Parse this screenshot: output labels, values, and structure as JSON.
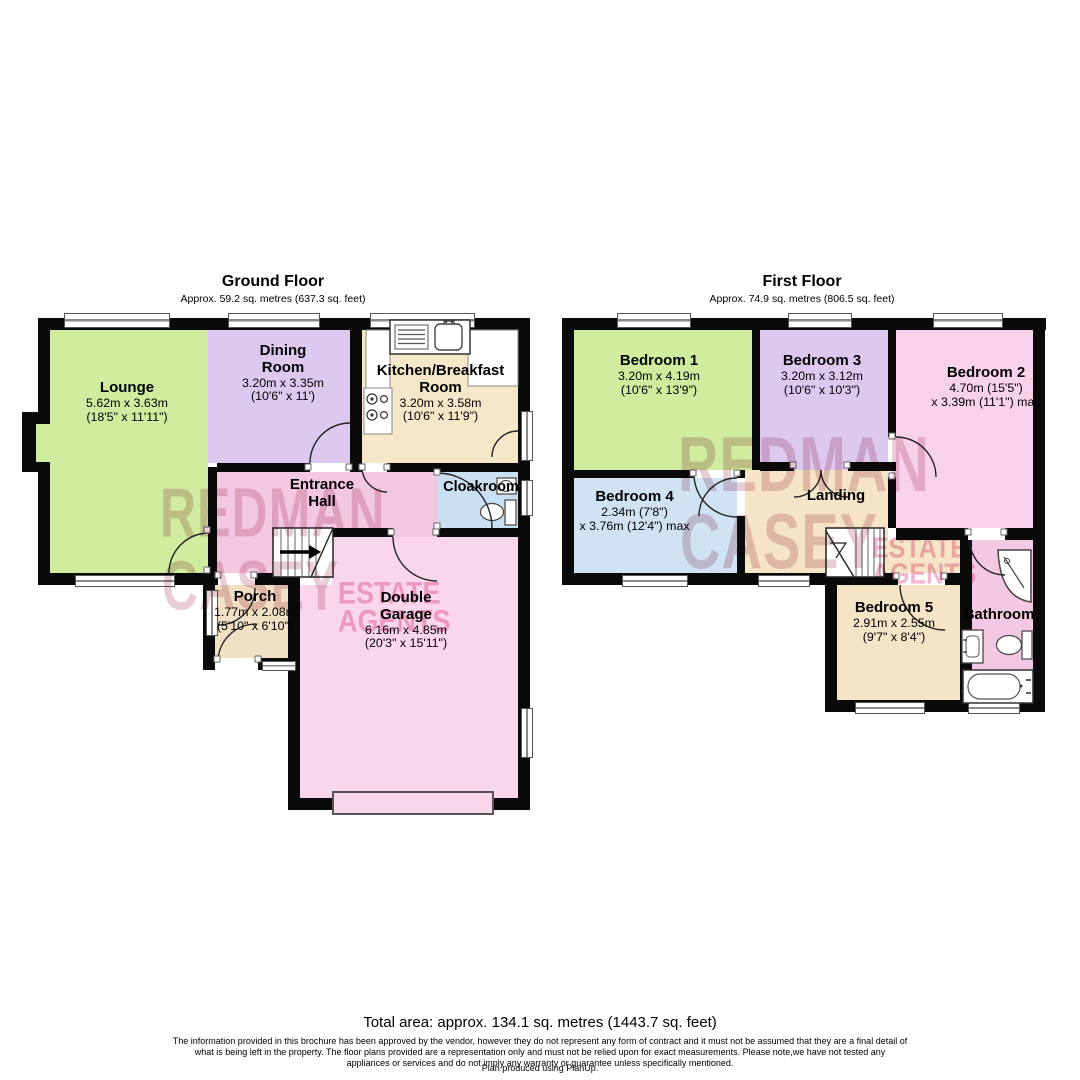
{
  "ground_floor": {
    "title": "Ground Floor",
    "subtitle": "Approx. 59.2 sq. metres (637.3 sq. feet)",
    "rooms": {
      "lounge": {
        "name": "Lounge",
        "dim_metric": "5.62m x 3.63m",
        "dim_imperial": "(18'5\" x 11'11\")"
      },
      "dining_room": {
        "name": "Dining Room",
        "dim_metric": "3.20m x 3.35m",
        "dim_imperial": "(10'6\" x 11')"
      },
      "kitchen": {
        "name": "Kitchen/Breakfast Room",
        "dim_metric": "3.20m x 3.58m",
        "dim_imperial": "(10'6\" x 11'9\")"
      },
      "entrance_hall": {
        "name": "Entrance Hall"
      },
      "cloakroom": {
        "name": "Cloakroom"
      },
      "porch": {
        "name": "Porch",
        "dim_metric": "1.77m x 2.08m",
        "dim_imperial": "(5'10\" x 6'10\")"
      },
      "double_garage": {
        "name": "Double Garage",
        "dim_metric": "6.16m x 4.85m",
        "dim_imperial": "(20'3\" x 15'11\")"
      }
    }
  },
  "first_floor": {
    "title": "First Floor",
    "subtitle": "Approx. 74.9 sq. metres (806.5 sq. feet)",
    "rooms": {
      "bedroom1": {
        "name": "Bedroom 1",
        "dim_metric": "3.20m x 4.19m",
        "dim_imperial": "(10'6\" x 13'9\")"
      },
      "bedroom3": {
        "name": "Bedroom 3",
        "dim_metric": "3.20m x 3.12m",
        "dim_imperial": "(10'6\" x 10'3\")"
      },
      "bedroom2": {
        "name": "Bedroom 2",
        "dim_metric": "4.70m (15'5\")",
        "dim_imperial": "x 3.39m (11'1\") max"
      },
      "bedroom4": {
        "name": "Bedroom 4",
        "dim_metric": "2.34m (7'8\")",
        "dim_imperial": "x 3.76m (12'4\") max"
      },
      "landing": {
        "name": "Landing"
      },
      "bedroom5": {
        "name": "Bedroom 5",
        "dim_metric": "2.91m x 2.55m",
        "dim_imperial": "(9'7\" x 8'4\")"
      },
      "bathroom": {
        "name": "Bathroom"
      }
    }
  },
  "watermark": {
    "word1": "REDMAN",
    "word2": "CASEY",
    "word3": "ESTATE",
    "word4": "AGENTS"
  },
  "footer": {
    "total_area": "Total area: approx. 134.1 sq. metres (1443.7 sq. feet)",
    "disclaimer": "The information provided in this brochure has been approved by the vendor, however they do not represent any form of contract and it must not be assumed that they are a final detail of what is being left in the property. The floor plans provided are a representation only and must not be relied upon for exact measurements. Please note,we have not tested any appliances or services and do not imply any warranty or guarantee unless specifically mentioned.",
    "produced_by": "Plan produced using PlanUp."
  },
  "colors": {
    "room_green": "#cfec9f",
    "room_purple": "#ddc9f0",
    "room_tan": "#f5e5c6",
    "kitchen_tan": "#f7e7c9",
    "porch_tan": "#f1e0c3",
    "hall_pink": "#f4c7e0",
    "garage_pink": "#fad6ea",
    "bedroom2_pink": "#f8d2e8",
    "bathroom_pink": "#f3c8e2",
    "cloakroom_blue": "#c9e0f2",
    "bedroom4_blue": "#cfe3f5",
    "wall_black": "#0a0a0a",
    "watermark_rose": "#ba6882",
    "watermark_pink": "#e87aaa"
  }
}
